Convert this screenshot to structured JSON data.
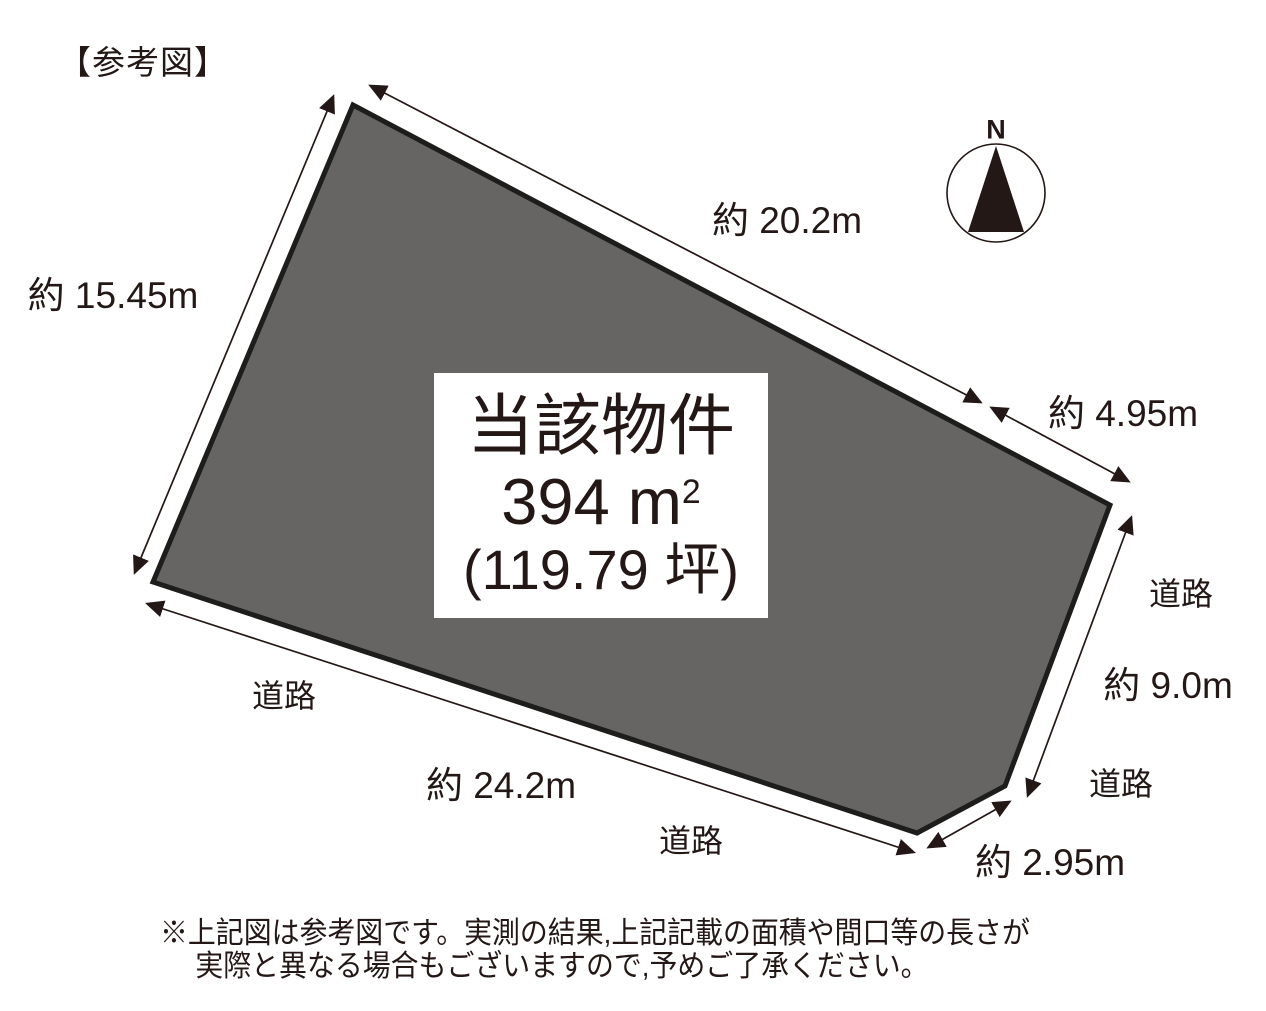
{
  "title": "【参考図】",
  "compass": {
    "north_label": "N"
  },
  "property_label": {
    "name": "当該物件",
    "area_main": "394 m",
    "area_sup": "2",
    "area_tsubo": "(119.79 坪)"
  },
  "dimensions": {
    "left": "約 15.45m",
    "top": "約 20.2m",
    "upper_right": "約 4.95m",
    "right": "約 9.0m",
    "lower_right": "約 2.95m",
    "bottom": "約 24.2m"
  },
  "roads": [
    "道路",
    "道路",
    "道路",
    "道路"
  ],
  "disclaimer": {
    "line1": "※上記図は参考図です。実測の結果,上記記載の面積や間口等の長さが",
    "line2": "実際と異なる場合もございますので,予めご了承ください。"
  },
  "colors": {
    "land_fill": "#666564",
    "ink": "#231815"
  }
}
